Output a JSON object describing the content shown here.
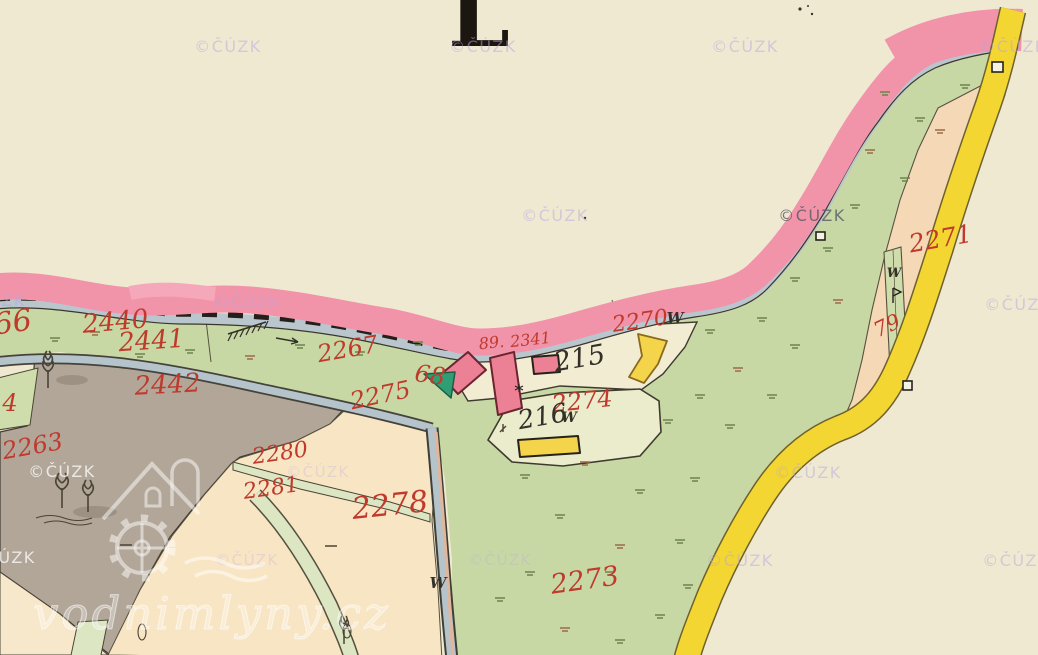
{
  "map": {
    "sheet_letter": "L",
    "site_watermark": "vodnimlyny.cz",
    "copyright_watermark": "©ČÚZK",
    "colors": {
      "cream": "#f1ead3",
      "pink_band": "#f193a9",
      "green": "#c7d8a4",
      "pale_green": "#dce6c2",
      "grey": "#b1a698",
      "peach": "#f8e5c4",
      "peach_right": "#f5d8b6",
      "yellow_road": "#f3d631",
      "stream_blue": "#b5c3cb",
      "building_pink": "#ec8196",
      "building_yellow": "#f3d44a",
      "garden_green": "#2f9e74",
      "label_red": "#bf3a2c",
      "label_black": "#33302a",
      "wm_lavender": "#b9a6e0",
      "wm_dark": "#5a5a64",
      "wm_white": "#ffffff"
    },
    "parcel_labels": [
      {
        "text": "66",
        "x": 14,
        "y": 332,
        "size": 30,
        "color": "red",
        "rot": -8
      },
      {
        "text": "2440",
        "x": 116,
        "y": 330,
        "size": 26,
        "color": "red",
        "rot": -5
      },
      {
        "text": "2441",
        "x": 152,
        "y": 349,
        "size": 26,
        "color": "red",
        "rot": -4
      },
      {
        "text": "2442",
        "x": 168,
        "y": 393,
        "size": 26,
        "color": "red",
        "rot": -3
      },
      {
        "text": "4",
        "x": 10,
        "y": 411,
        "size": 24,
        "color": "red",
        "rot": 0
      },
      {
        "text": "2263",
        "x": 34,
        "y": 454,
        "size": 24,
        "color": "red",
        "rot": -10
      },
      {
        "text": "2267",
        "x": 349,
        "y": 357,
        "size": 24,
        "color": "red",
        "rot": -10
      },
      {
        "text": "2275",
        "x": 382,
        "y": 403,
        "size": 24,
        "color": "red",
        "rot": -12
      },
      {
        "text": "68",
        "x": 429,
        "y": 383,
        "size": 24,
        "color": "red",
        "rot": 8
      },
      {
        "text": "89.",
        "x": 492,
        "y": 348,
        "size": 16,
        "color": "red",
        "rot": -6
      },
      {
        "text": "2341",
        "x": 531,
        "y": 345,
        "size": 16,
        "color": "red",
        "rot": -6
      },
      {
        "text": "215",
        "x": 581,
        "y": 367,
        "size": 27,
        "color": "black",
        "rot": -10
      },
      {
        "text": "2270",
        "x": 641,
        "y": 328,
        "size": 22,
        "color": "red",
        "rot": -8
      },
      {
        "text": "W",
        "x": 675,
        "y": 323,
        "size": 15,
        "color": "black",
        "rot": 0
      },
      {
        "text": "2274",
        "x": 583,
        "y": 409,
        "size": 24,
        "color": "red",
        "rot": -6
      },
      {
        "text": "W",
        "x": 569,
        "y": 422,
        "size": 14,
        "color": "black",
        "rot": 0
      },
      {
        "text": "216",
        "x": 544,
        "y": 425,
        "size": 26,
        "color": "black",
        "rot": -10
      },
      {
        "text": "2278",
        "x": 391,
        "y": 515,
        "size": 30,
        "color": "red",
        "rot": -6
      },
      {
        "text": "2280",
        "x": 281,
        "y": 460,
        "size": 22,
        "color": "red",
        "rot": -8
      },
      {
        "text": "2281",
        "x": 272,
        "y": 495,
        "size": 22,
        "color": "red",
        "rot": -8
      },
      {
        "text": "2273",
        "x": 586,
        "y": 589,
        "size": 27,
        "color": "red",
        "rot": -8
      },
      {
        "text": "2271",
        "x": 942,
        "y": 247,
        "size": 25,
        "color": "red",
        "rot": -10
      },
      {
        "text": "79",
        "x": 890,
        "y": 332,
        "size": 21,
        "color": "red",
        "rot": -25
      },
      {
        "text": "W",
        "x": 894,
        "y": 277,
        "size": 13,
        "color": "black",
        "rot": 0
      },
      {
        "text": "W",
        "x": 438,
        "y": 588,
        "size": 15,
        "color": "black",
        "rot": 0
      }
    ],
    "watermarks": [
      {
        "x": 228,
        "y": 52,
        "style": "lav"
      },
      {
        "x": 483,
        "y": 52,
        "style": "lav"
      },
      {
        "x": 745,
        "y": 52,
        "style": "lav"
      },
      {
        "x": 1013,
        "y": 52,
        "style": "lav"
      },
      {
        "x": 555,
        "y": 221,
        "style": "lav"
      },
      {
        "x": 812,
        "y": 221,
        "style": "dark"
      },
      {
        "x": -8,
        "y": 306,
        "style": "lav"
      },
      {
        "x": 247,
        "y": 308,
        "style": "lav"
      },
      {
        "x": 1018,
        "y": 310,
        "style": "lav"
      },
      {
        "x": 62,
        "y": 477,
        "style": "white"
      },
      {
        "x": 318,
        "y": 477,
        "style": "faint"
      },
      {
        "x": 808,
        "y": 478,
        "style": "lav"
      },
      {
        "x": 2,
        "y": 563,
        "style": "white"
      },
      {
        "x": 247,
        "y": 565,
        "style": "faint"
      },
      {
        "x": 500,
        "y": 565,
        "style": "faint"
      },
      {
        "x": 740,
        "y": 566,
        "style": "lav"
      },
      {
        "x": 1016,
        "y": 566,
        "style": "lav"
      }
    ]
  }
}
